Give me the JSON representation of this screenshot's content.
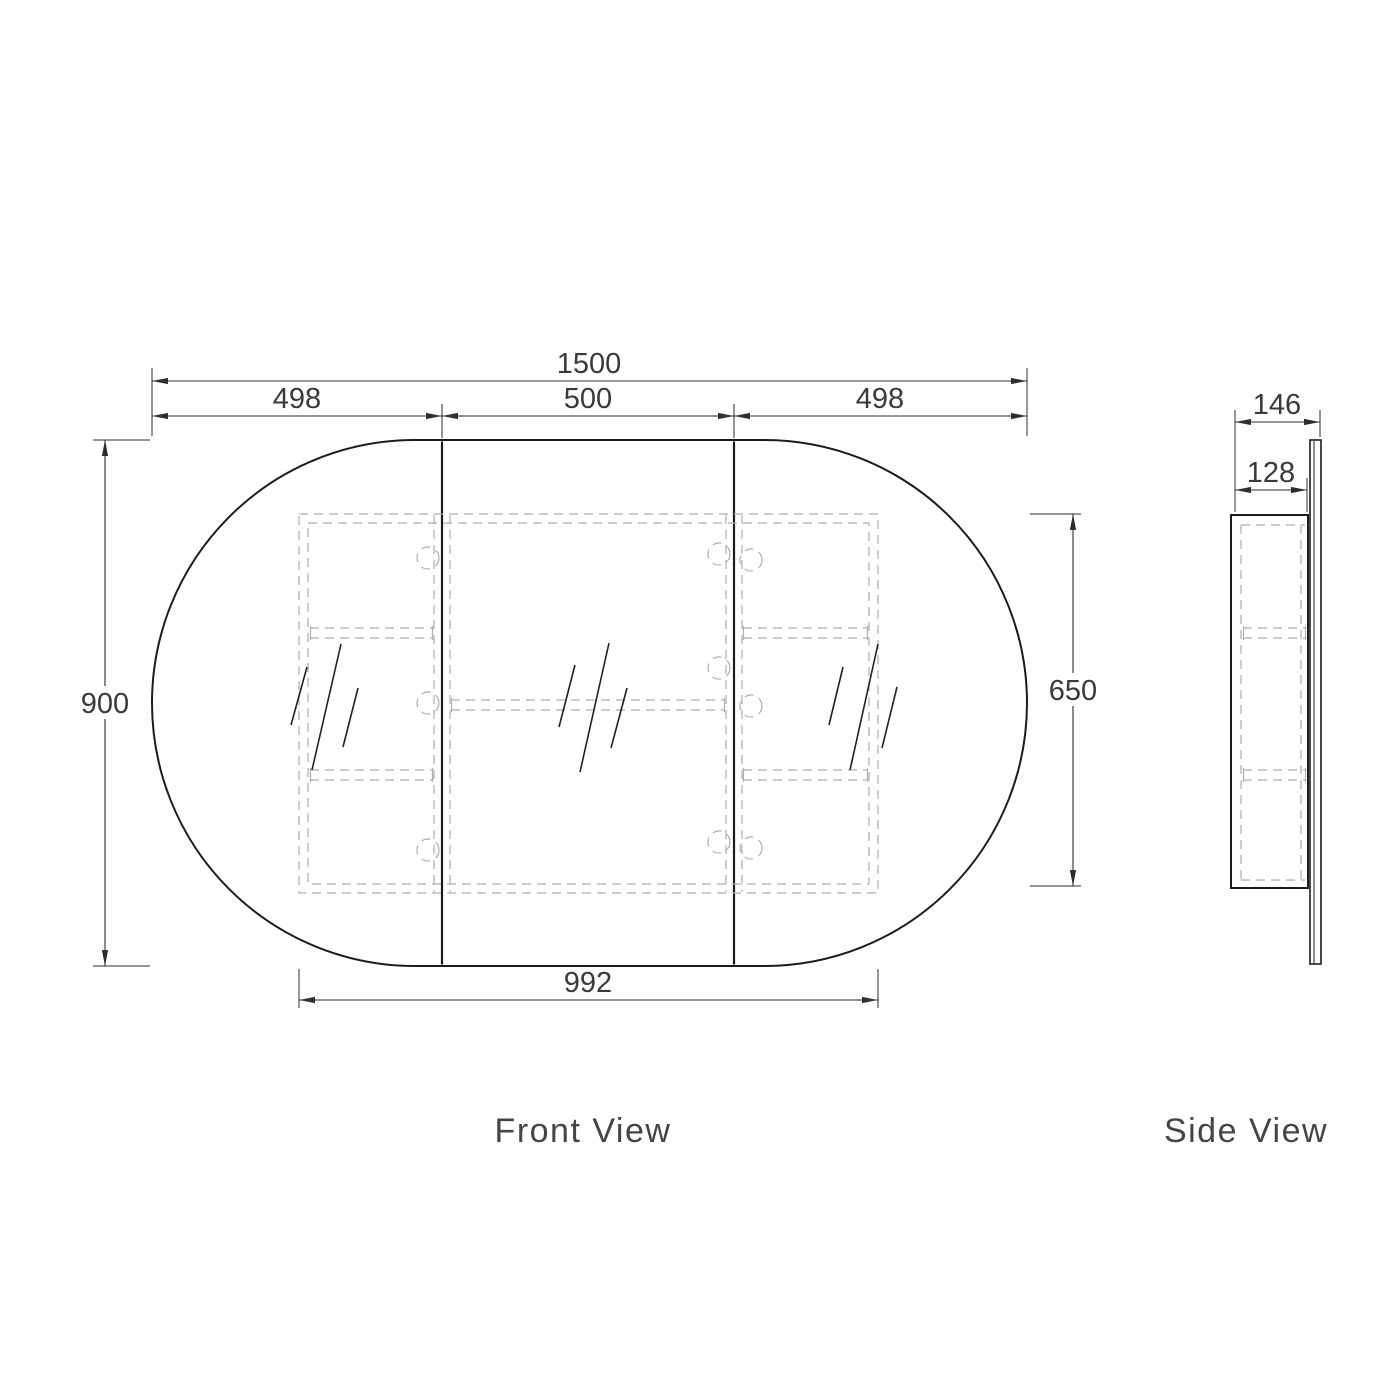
{
  "drawing": {
    "front_view": {
      "label": "Front View",
      "dimensions": {
        "overall_width": "1500",
        "left_door_width": "498",
        "center_door_width": "500",
        "right_door_width": "498",
        "overall_height": "900",
        "cabinet_height": "650",
        "cabinet_width": "992"
      }
    },
    "side_view": {
      "label": "Side View",
      "dimensions": {
        "overall_depth": "146",
        "cabinet_depth": "128"
      }
    }
  },
  "colors": {
    "outline": "#1c1c1c",
    "hidden_lines": "#aeaeae",
    "dimension_text": "#3a3a3a",
    "label_text": "#454545",
    "background": "#ffffff"
  }
}
